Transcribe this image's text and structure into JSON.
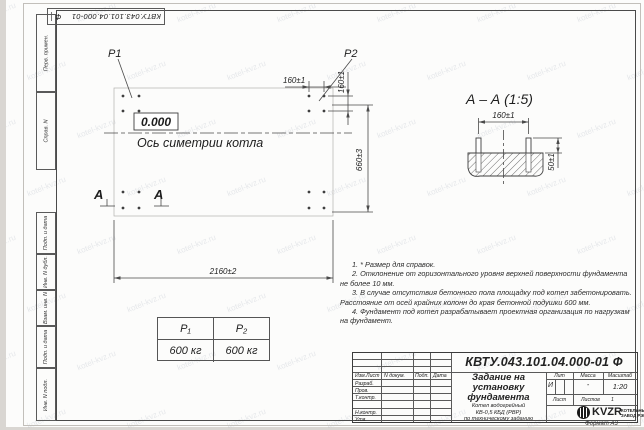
{
  "watermark": {
    "text": "kotel-kvz.ru"
  },
  "stamp": {
    "number": "КВТУ.043.101.04.000-01",
    "suffix": "Ф"
  },
  "margin_labels": {
    "perv": "Перв. примен.",
    "sprav": "Справ. N",
    "podp1": "Подп. и дата",
    "inv_dubl": "Инв. N дубл.",
    "vzam": "Взам. инв. N",
    "podp2": "Подп. и дата",
    "inv_podl": "Инв. N подл."
  },
  "plan": {
    "p1_label": "P1",
    "p2_label": "P2",
    "elevation": "0.000",
    "axis_label": "Ось симетрии котла",
    "dim_width": "2160±2",
    "dim_height": "660±3",
    "dim_bolt_h": "160±1",
    "dim_bolt_v": "160±1",
    "section_letter_left": "А",
    "section_letter_right": "А"
  },
  "section": {
    "title": "А – А (1:5)",
    "dim_bolts": "160±1",
    "dim_height": "50±1"
  },
  "notes": [
    "1. * Размер для справок.",
    "2. Отклонение от горизонтального уровня верхней поверхности фундамента не более 10 мм.",
    "3. В случае отсутствия бетонного пола площадку под котел забетонировать. Расстояние от осей крайних колонн до края бетонной подушки 600 мм.",
    "4. Фундамент под котел разрабатывает проектная организация по нагрузкам на фундамент."
  ],
  "load_table": {
    "headers": [
      "P₁",
      "P₂"
    ],
    "values": [
      "600 кг",
      "600 кг"
    ]
  },
  "title_block": {
    "doc_number": "КВТУ.043.101.04.000-01 Ф",
    "title_lines": [
      "Задание на",
      "установку",
      "фундамента"
    ],
    "subtitle_lines": [
      "Котел водогрейный",
      "КВ-0,5 КБД (РВР)",
      "по техническому заданию"
    ],
    "header_cols": [
      "Изм.Лист",
      "N докум.",
      "Подп.",
      "Дата"
    ],
    "rows": [
      "Разраб.",
      "Пров.",
      "Т.контр.",
      "Н.контр.",
      "Утв."
    ],
    "lit_label": "Лит",
    "lit_value": "И",
    "mass_label": "Масса",
    "mass_value": "-",
    "scale_label": "Масштаб",
    "scale_value": "1:20",
    "sheet_label": "Лист",
    "sheets_label": "Листов",
    "sheets_value": "1",
    "company": "KVZR",
    "company_sub1": "КОТЕЛЬНЫЙ",
    "company_sub2": "ЗАВОД РЭП",
    "format_label": "Формат А3"
  }
}
